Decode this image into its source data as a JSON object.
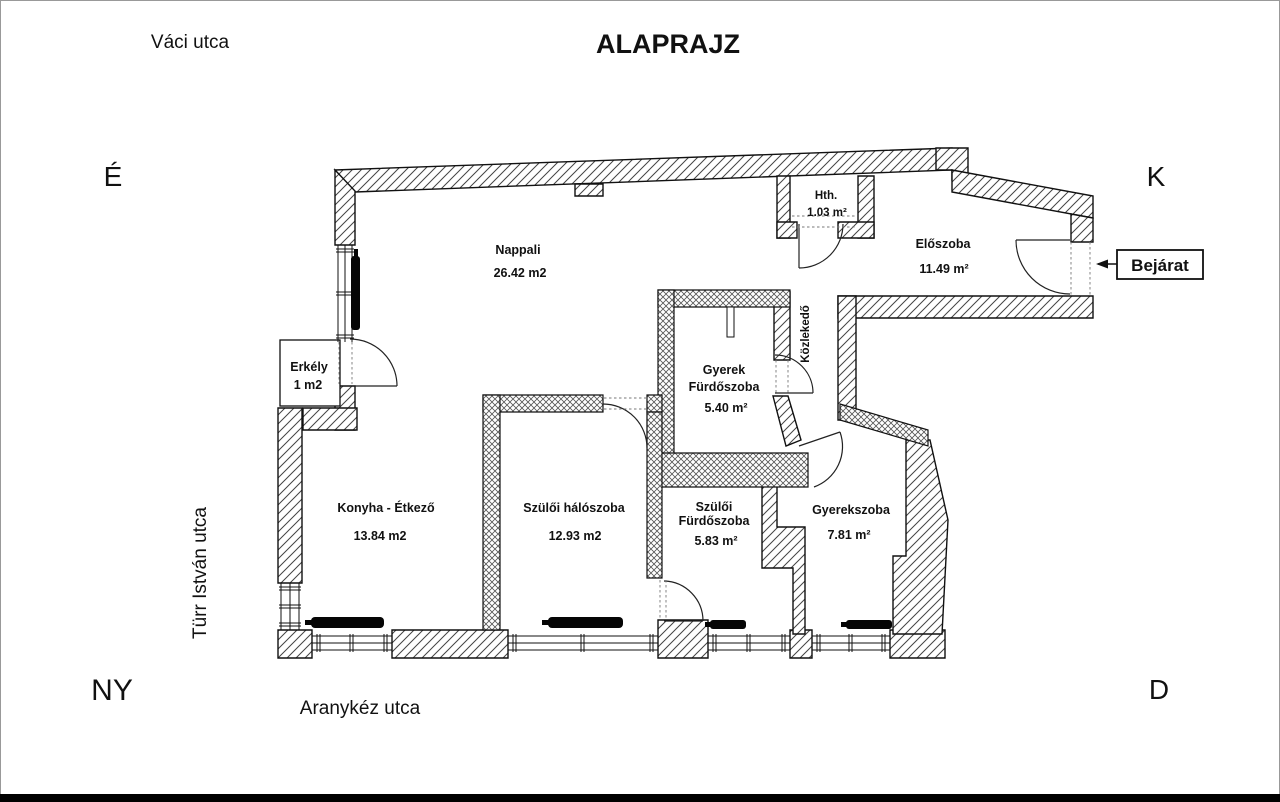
{
  "title": "ALAPRAJZ",
  "streets": {
    "top": "Váci utca",
    "left": "Türr István utca",
    "bottom": "Aranykéz utca"
  },
  "compass": {
    "north": "É",
    "east": "K",
    "west": "NY",
    "south": "D"
  },
  "entrance": {
    "label": "Bejárat"
  },
  "rooms": {
    "nappali": {
      "name": "Nappali",
      "area": "26.42 m2"
    },
    "hth": {
      "name": "Hth.",
      "area": "1.03 m²"
    },
    "eloszoba": {
      "name": "Előszoba",
      "area": "11.49 m²"
    },
    "erkely": {
      "name": "Erkély",
      "area": "1 m2"
    },
    "gyerek_furdoszoba": {
      "name_line1": "Gyerek",
      "name_line2": "Fürdőszoba",
      "area": "5.40 m²"
    },
    "kozlekedo": {
      "name": "Közlekedő"
    },
    "konyha_etkezo": {
      "name": "Konyha - Étkező",
      "area": "13.84 m2"
    },
    "szuloi_haloszoba": {
      "name": "Szülői hálószoba",
      "area": "12.93 m2"
    },
    "szuloi_furdoszoba": {
      "name_line1": "Szülői",
      "name_line2": "Fürdőszoba",
      "area": "5.83 m²"
    },
    "gyerekszoba": {
      "name": "Gyerekszoba",
      "area": "7.81 m²"
    }
  },
  "colors": {
    "ink": "#111111",
    "background": "#ffffff"
  }
}
